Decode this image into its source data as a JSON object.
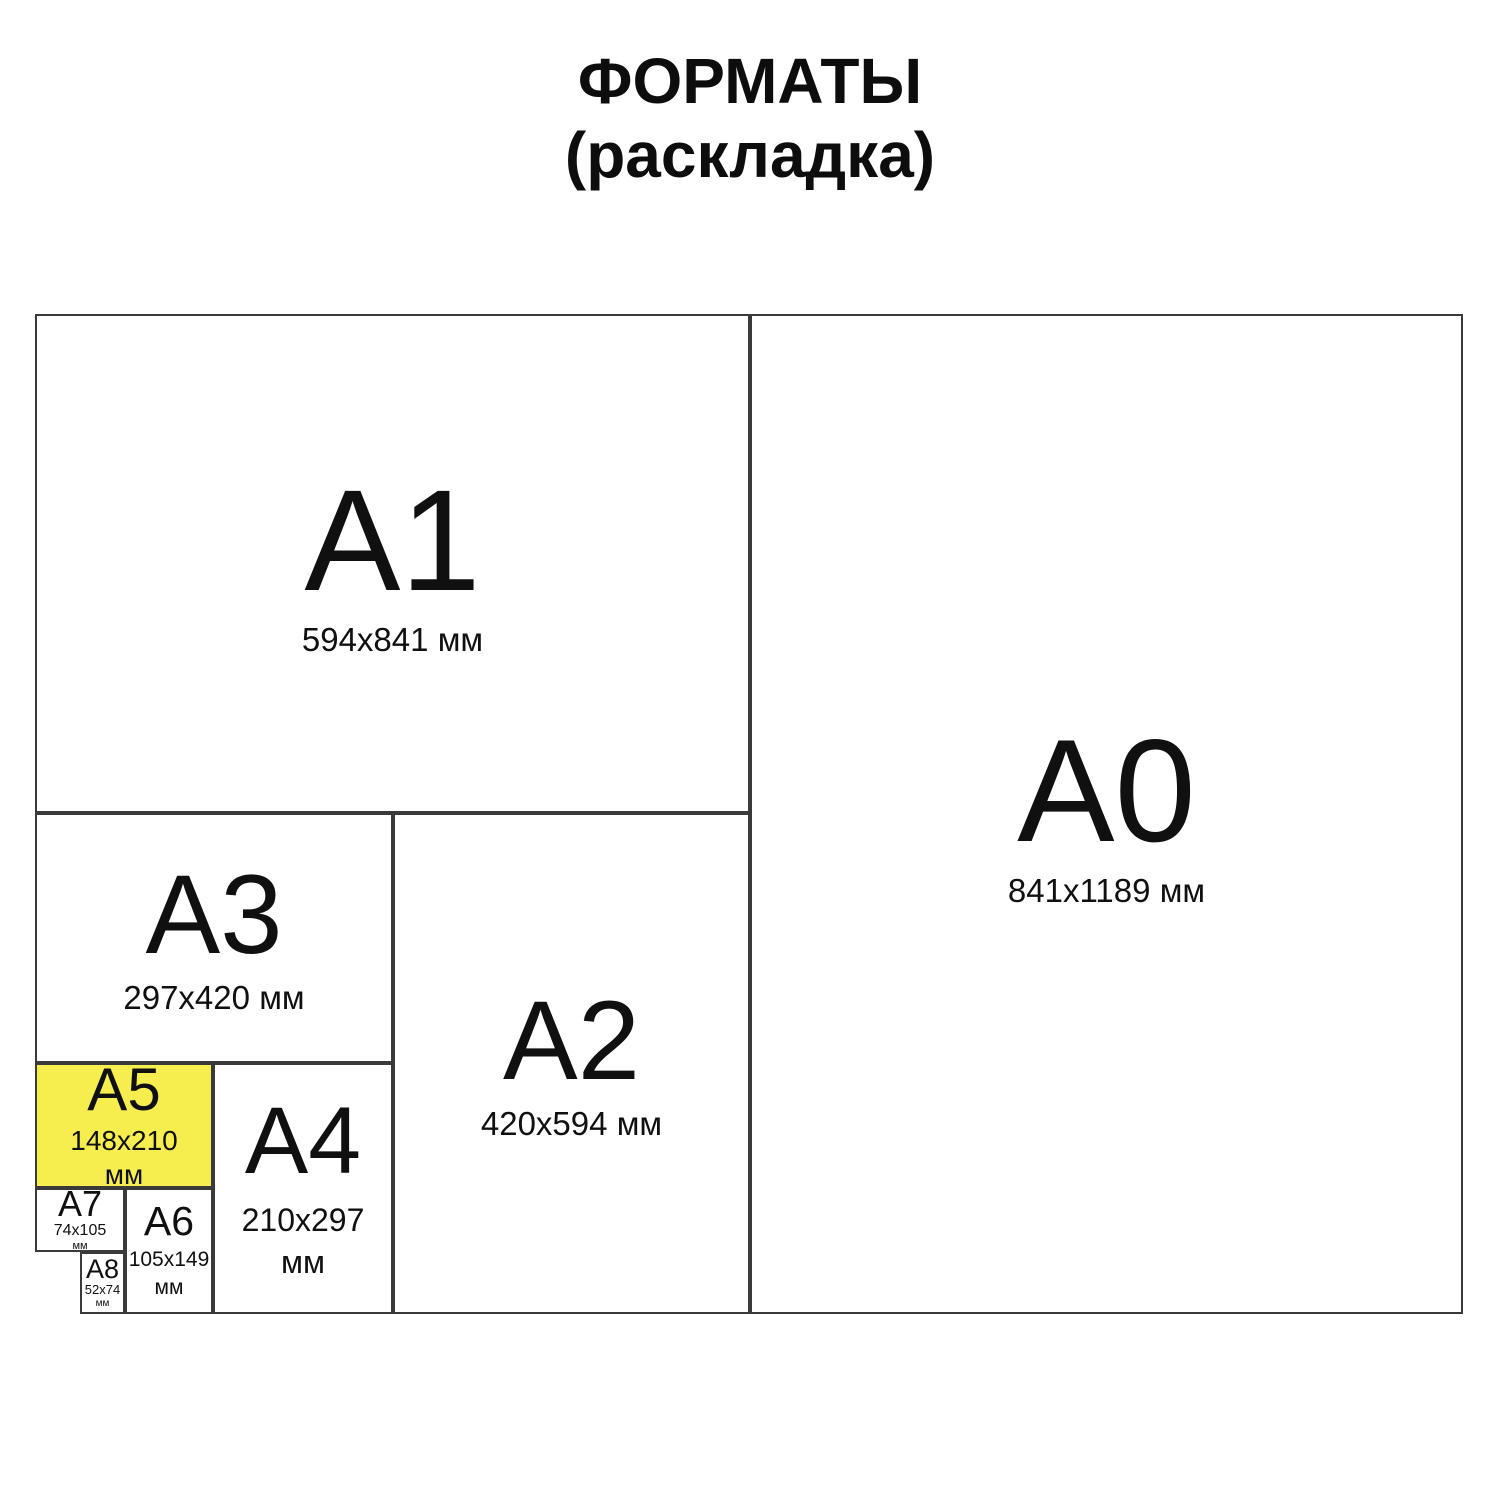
{
  "title": {
    "line1": "ФОРМАТЫ",
    "line2": "(раскладка)"
  },
  "colors": {
    "highlight_fill": "#f6ee4f",
    "border": "#3a3a3a",
    "text": "#101010",
    "background": "#ffffff"
  },
  "formats": [
    {
      "label": "A0",
      "size": "841x1189",
      "unit": "мм",
      "highlighted": false
    },
    {
      "label": "A1",
      "size": "594x841",
      "unit": "мм",
      "highlighted": false
    },
    {
      "label": "A2",
      "size": "420x594",
      "unit": "мм",
      "highlighted": false
    },
    {
      "label": "A3",
      "size": "297x420",
      "unit": "мм",
      "highlighted": false
    },
    {
      "label": "A4",
      "size": "210x297",
      "unit": "мм",
      "highlighted": false
    },
    {
      "label": "A5",
      "size": "148x210",
      "unit": "мм",
      "highlighted": true
    },
    {
      "label": "A6",
      "size": "105x149",
      "unit": "мм",
      "highlighted": false
    },
    {
      "label": "A7",
      "size": "74x105",
      "unit": "мм",
      "highlighted": false
    },
    {
      "label": "A8",
      "size": "52x74",
      "unit": "мм",
      "highlighted": false
    }
  ]
}
